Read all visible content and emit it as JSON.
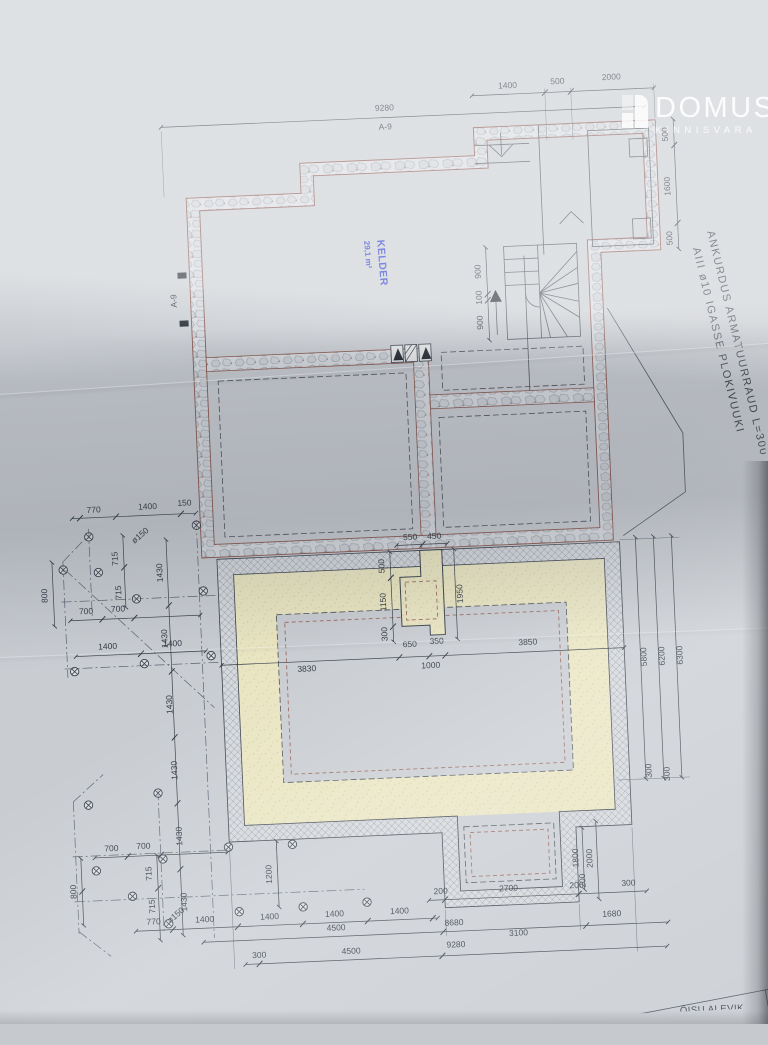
{
  "logo": {
    "name": "DOMUS",
    "subtitle": "KINNISVARA"
  },
  "stamp": {
    "room": "KELDER",
    "area": "29,1 m²"
  },
  "annotation": {
    "line1": "ANKURDUS ARMATUURRAUD L=300",
    "line2": "AIII  ø10 IGASSE PLOKIVUUKI"
  },
  "title_block": {
    "code": "S-20",
    "scale": "M",
    "location": "ÕISU ALEVIK"
  },
  "colors": {
    "paper": "#c9cdd2",
    "line": "#39404b",
    "wall_edge": "#8a564e",
    "floor_sand": "#e9e5c2",
    "stamp_blue": "#2638c8",
    "watermark": "#ffffff"
  },
  "labels": [
    {
      "t": "9280",
      "x": 402,
      "y": 111
    },
    {
      "t": "A-9",
      "x": 402,
      "y": 130
    },
    {
      "t": "1400",
      "x": 526,
      "y": 94
    },
    {
      "t": "500",
      "x": 576,
      "y": 92
    },
    {
      "t": "2000",
      "x": 630,
      "y": 90
    },
    {
      "t": "500",
      "x": 684,
      "y": 147,
      "r": -90
    },
    {
      "t": "1600",
      "x": 684,
      "y": 199,
      "r": -90
    },
    {
      "t": "500",
      "x": 684,
      "y": 251,
      "r": -90
    },
    {
      "t": "900",
      "x": 491,
      "y": 276,
      "r": -90
    },
    {
      "t": "100",
      "x": 491,
      "y": 302,
      "r": -90
    },
    {
      "t": "900",
      "x": 491,
      "y": 327,
      "r": -90
    },
    {
      "t": "A-9",
      "x": 186,
      "y": 292,
      "r": -90
    },
    {
      "t": "770",
      "x": 94,
      "y": 500
    },
    {
      "t": "1400",
      "x": 148,
      "y": 499
    },
    {
      "t": "150",
      "x": 185,
      "y": 497
    },
    {
      "t": "ø150",
      "x": 141,
      "y": 527,
      "r": -38
    },
    {
      "t": "715",
      "x": 116,
      "y": 547,
      "r": -90
    },
    {
      "t": "715",
      "x": 118,
      "y": 581,
      "r": -90
    },
    {
      "t": "800",
      "x": 44,
      "y": 581,
      "r": -90
    },
    {
      "t": "700",
      "x": 82,
      "y": 601
    },
    {
      "t": "700",
      "x": 114,
      "y": 600
    },
    {
      "t": "1400",
      "x": 102,
      "y": 637
    },
    {
      "t": "1400",
      "x": 167,
      "y": 637
    },
    {
      "t": "1430",
      "x": 160,
      "y": 563,
      "r": -90
    },
    {
      "t": "1430",
      "x": 162,
      "y": 629,
      "r": -90
    },
    {
      "t": "1430",
      "x": 164,
      "y": 695,
      "r": -90
    },
    {
      "t": "1430",
      "x": 166,
      "y": 761,
      "r": -90
    },
    {
      "t": "1430",
      "x": 168,
      "y": 827,
      "r": -90
    },
    {
      "t": "1430",
      "x": 170,
      "y": 893,
      "r": -90
    },
    {
      "t": "550",
      "x": 409,
      "y": 541
    },
    {
      "t": "450",
      "x": 433,
      "y": 541
    },
    {
      "t": "500",
      "x": 382,
      "y": 566,
      "r": -90
    },
    {
      "t": "1150",
      "x": 382,
      "y": 602,
      "r": -90
    },
    {
      "t": "300",
      "x": 382,
      "y": 634,
      "r": -90
    },
    {
      "t": "1950",
      "x": 459,
      "y": 597,
      "r": -90
    },
    {
      "t": "3830",
      "x": 300,
      "y": 668
    },
    {
      "t": "650",
      "x": 404,
      "y": 648
    },
    {
      "t": "350",
      "x": 431,
      "y": 646
    },
    {
      "t": "1000",
      "x": 424,
      "y": 670
    },
    {
      "t": "3850",
      "x": 522,
      "y": 651
    },
    {
      "t": "5800",
      "x": 640,
      "y": 668,
      "r": -90
    },
    {
      "t": "6200",
      "x": 658,
      "y": 668,
      "r": -90
    },
    {
      "t": "6300",
      "x": 676,
      "y": 668,
      "r": -90
    },
    {
      "t": "300",
      "x": 640,
      "y": 782,
      "r": -90
    },
    {
      "t": "300",
      "x": 658,
      "y": 786,
      "r": -90
    },
    {
      "t": "700",
      "x": 97,
      "y": 839
    },
    {
      "t": "700",
      "x": 129,
      "y": 838
    },
    {
      "t": "715",
      "x": 136,
      "y": 863,
      "r": -90
    },
    {
      "t": "715",
      "x": 138,
      "y": 896,
      "r": -90
    },
    {
      "t": "800",
      "x": 60,
      "y": 878,
      "r": -90
    },
    {
      "t": "ø150",
      "x": 160,
      "y": 908,
      "r": -38
    },
    {
      "t": "1200",
      "x": 256,
      "y": 869,
      "r": -90
    },
    {
      "t": "1800",
      "x": 563,
      "y": 866,
      "r": -90
    },
    {
      "t": "2000",
      "x": 577,
      "y": 867,
      "r": -90
    },
    {
      "t": "200",
      "x": 569,
      "y": 889,
      "r": -90
    },
    {
      "t": "770",
      "x": 136,
      "y": 914
    },
    {
      "t": "1400",
      "x": 187,
      "y": 914
    },
    {
      "t": "1400",
      "x": 252,
      "y": 914
    },
    {
      "t": "1400",
      "x": 317,
      "y": 914
    },
    {
      "t": "1400",
      "x": 382,
      "y": 914
    },
    {
      "t": "200",
      "x": 424,
      "y": 896
    },
    {
      "t": "2700",
      "x": 492,
      "y": 896
    },
    {
      "t": "200",
      "x": 560,
      "y": 896
    },
    {
      "t": "300",
      "x": 612,
      "y": 896
    },
    {
      "t": "4500",
      "x": 318,
      "y": 928
    },
    {
      "t": "8680",
      "x": 436,
      "y": 928
    },
    {
      "t": "3100",
      "x": 500,
      "y": 941
    },
    {
      "t": "1680",
      "x": 594,
      "y": 926
    },
    {
      "t": "300",
      "x": 240,
      "y": 952
    },
    {
      "t": "4500",
      "x": 332,
      "y": 952
    },
    {
      "t": "9280",
      "x": 437,
      "y": 950
    }
  ],
  "piles": [
    [
      88,
      524
    ],
    [
      196,
      517
    ],
    [
      61,
      556
    ],
    [
      96,
      560
    ],
    [
      133,
      588
    ],
    [
      200,
      583
    ],
    [
      68,
      658
    ],
    [
      138,
      653
    ],
    [
      205,
      648
    ],
    [
      76,
      792
    ],
    [
      146,
      783
    ],
    [
      81,
      858
    ],
    [
      148,
      849
    ],
    [
      214,
      840
    ],
    [
      278,
      840
    ],
    [
      116,
      885
    ],
    [
      151,
      914
    ],
    [
      222,
      905
    ],
    [
      286,
      903
    ],
    [
      350,
      901
    ]
  ]
}
